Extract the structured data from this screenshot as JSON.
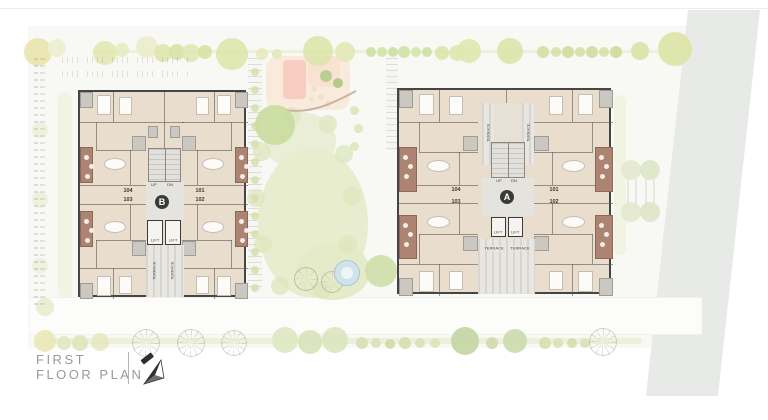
{
  "page": {
    "title_line1": "FIRST",
    "title_line2": "FLOOR PLAN"
  },
  "buildings": {
    "b": {
      "badge": "B",
      "up_label": "UP",
      "dn_label": "DN",
      "lift1_label": "LIFT",
      "lift2_label": "LIFT",
      "terrace_left_label": "TERRACE",
      "terrace_right_label": "TERRACE",
      "units": {
        "u104": "104",
        "u103": "103",
        "u101": "101",
        "u102": "102"
      }
    },
    "a": {
      "badge": "A",
      "up_label": "UP",
      "dn_label": "DN",
      "lift1_label": "LIFT",
      "lift2_label": "LIFT",
      "terrace_top_left_label": "TERRACE",
      "terrace_top_right_label": "TERRACE",
      "terrace_bottom_left_label": "TERRACE",
      "terrace_bottom_right_label": "TERRACE",
      "units": {
        "u104": "104",
        "u103": "103",
        "u101": "101",
        "u102": "102"
      }
    }
  },
  "site": {
    "colors": {
      "building_floor": "#e9ddcd",
      "wall": "#454545",
      "terrace_brown": "#ad8372",
      "lawn": "#e8edcf",
      "road": "#e8eae8",
      "pool": "#cfe3eb",
      "peach": "#f9ead9",
      "salmon": "#f6cdc0"
    },
    "trees_top": [
      [
        38,
        52,
        14,
        "#e9e6ae"
      ],
      [
        57,
        48,
        9,
        "#eef0d2"
      ],
      [
        105,
        53,
        12,
        "#e2e9b2"
      ],
      [
        122,
        50,
        7,
        "#e8ecc4"
      ],
      [
        147,
        47,
        11,
        "#ebeecb"
      ],
      [
        163,
        53,
        9,
        "#dfe7ae"
      ],
      [
        177,
        52,
        8,
        "#d9e3a8"
      ],
      [
        191,
        53,
        9,
        "#e0e8b4"
      ],
      [
        205,
        52,
        7,
        "#d8e2a4"
      ],
      [
        232,
        54,
        16,
        "#dee7ad"
      ],
      [
        262,
        54,
        6,
        "#e6ebc0"
      ],
      [
        277,
        54,
        5,
        "#e2e8ba"
      ],
      [
        318,
        51,
        15,
        "#dde6ac"
      ],
      [
        345,
        52,
        10,
        "#e2e9b6"
      ],
      [
        371,
        52,
        5,
        "#cfe0a2"
      ],
      [
        382,
        52,
        5,
        "#d4e3a8"
      ],
      [
        393,
        52,
        5,
        "#cde0a0"
      ],
      [
        404,
        52,
        6,
        "#d2e2a6"
      ],
      [
        416,
        52,
        5,
        "#d7e5ac"
      ],
      [
        427,
        52,
        5,
        "#cfe0a2"
      ],
      [
        442,
        53,
        7,
        "#dce6ae"
      ],
      [
        457,
        53,
        8,
        "#e0e8b2"
      ],
      [
        469,
        51,
        12,
        "#dfe8b0"
      ],
      [
        510,
        51,
        13,
        "#dce6aa"
      ],
      [
        543,
        52,
        6,
        "#d2e0a4"
      ],
      [
        556,
        52,
        5,
        "#d6e2a8"
      ],
      [
        568,
        52,
        6,
        "#cfdea0"
      ],
      [
        580,
        52,
        5,
        "#d4e0a6"
      ],
      [
        592,
        52,
        6,
        "#d0dea2"
      ],
      [
        604,
        52,
        5,
        "#d6e2a8"
      ],
      [
        616,
        52,
        6,
        "#cddc9e"
      ],
      [
        640,
        51,
        9,
        "#d8e4a8"
      ],
      [
        675,
        49,
        17,
        "#dce5a6"
      ]
    ],
    "trees_bottom": [
      [
        45,
        341,
        11,
        "#ebe8b6"
      ],
      [
        64,
        343,
        7,
        "#e4e8c0"
      ],
      [
        80,
        343,
        8,
        "#dfe6ba"
      ],
      [
        100,
        342,
        9,
        "#e8e9c2"
      ],
      [
        145,
        342,
        13,
        "spiky"
      ],
      [
        190,
        342,
        13,
        "spiky"
      ],
      [
        233,
        342,
        12,
        "spiky"
      ],
      [
        285,
        340,
        13,
        "#dfe8c2"
      ],
      [
        310,
        342,
        12,
        "#d8e4ba"
      ],
      [
        335,
        340,
        13,
        "#dce6be"
      ],
      [
        362,
        343,
        6,
        "#d5e2b2"
      ],
      [
        376,
        343,
        5,
        "#d8e4b6"
      ],
      [
        390,
        344,
        5,
        "#cfdcaa"
      ],
      [
        405,
        343,
        6,
        "#d4e0b0"
      ],
      [
        420,
        343,
        5,
        "#d8e4b6"
      ],
      [
        435,
        343,
        5,
        "#dce6ba"
      ],
      [
        465,
        341,
        14,
        "#c5d6a4"
      ],
      [
        492,
        343,
        6,
        "#cfdcae"
      ],
      [
        515,
        341,
        12,
        "#cbdcae"
      ],
      [
        545,
        343,
        6,
        "#d4e0b2"
      ],
      [
        558,
        343,
        5,
        "#d8e2b6"
      ],
      [
        572,
        343,
        5,
        "#d3dfae"
      ],
      [
        585,
        343,
        5,
        "#d8e2b6"
      ],
      [
        602,
        341,
        13,
        "spiky"
      ]
    ],
    "trees_alley": [
      [
        631,
        170,
        10,
        "#e3e9cf"
      ],
      [
        650,
        170,
        10,
        "#dfe6c8"
      ],
      [
        631,
        212,
        10,
        "#e3e9cf"
      ],
      [
        650,
        212,
        10,
        "#dfe6c8"
      ]
    ],
    "trees_left": [
      [
        40,
        130,
        8,
        "#eff1dd"
      ],
      [
        40,
        200,
        8,
        "#eff1dd"
      ],
      [
        40,
        266,
        8,
        "#eff1dd"
      ],
      [
        45,
        307,
        9,
        "#e9eecf"
      ]
    ],
    "courtyard_trees": [
      [
        275,
        125,
        20,
        "#c9dd9e"
      ],
      [
        381,
        271,
        16,
        "#cfdfa9"
      ]
    ],
    "lawn_fringe": [
      [
        262,
        152
      ],
      [
        256,
        198
      ],
      [
        263,
        244
      ],
      [
        280,
        286
      ],
      [
        322,
        290
      ],
      [
        348,
        244
      ],
      [
        352,
        196
      ],
      [
        344,
        154
      ],
      [
        292,
        116
      ],
      [
        328,
        124
      ]
    ]
  }
}
